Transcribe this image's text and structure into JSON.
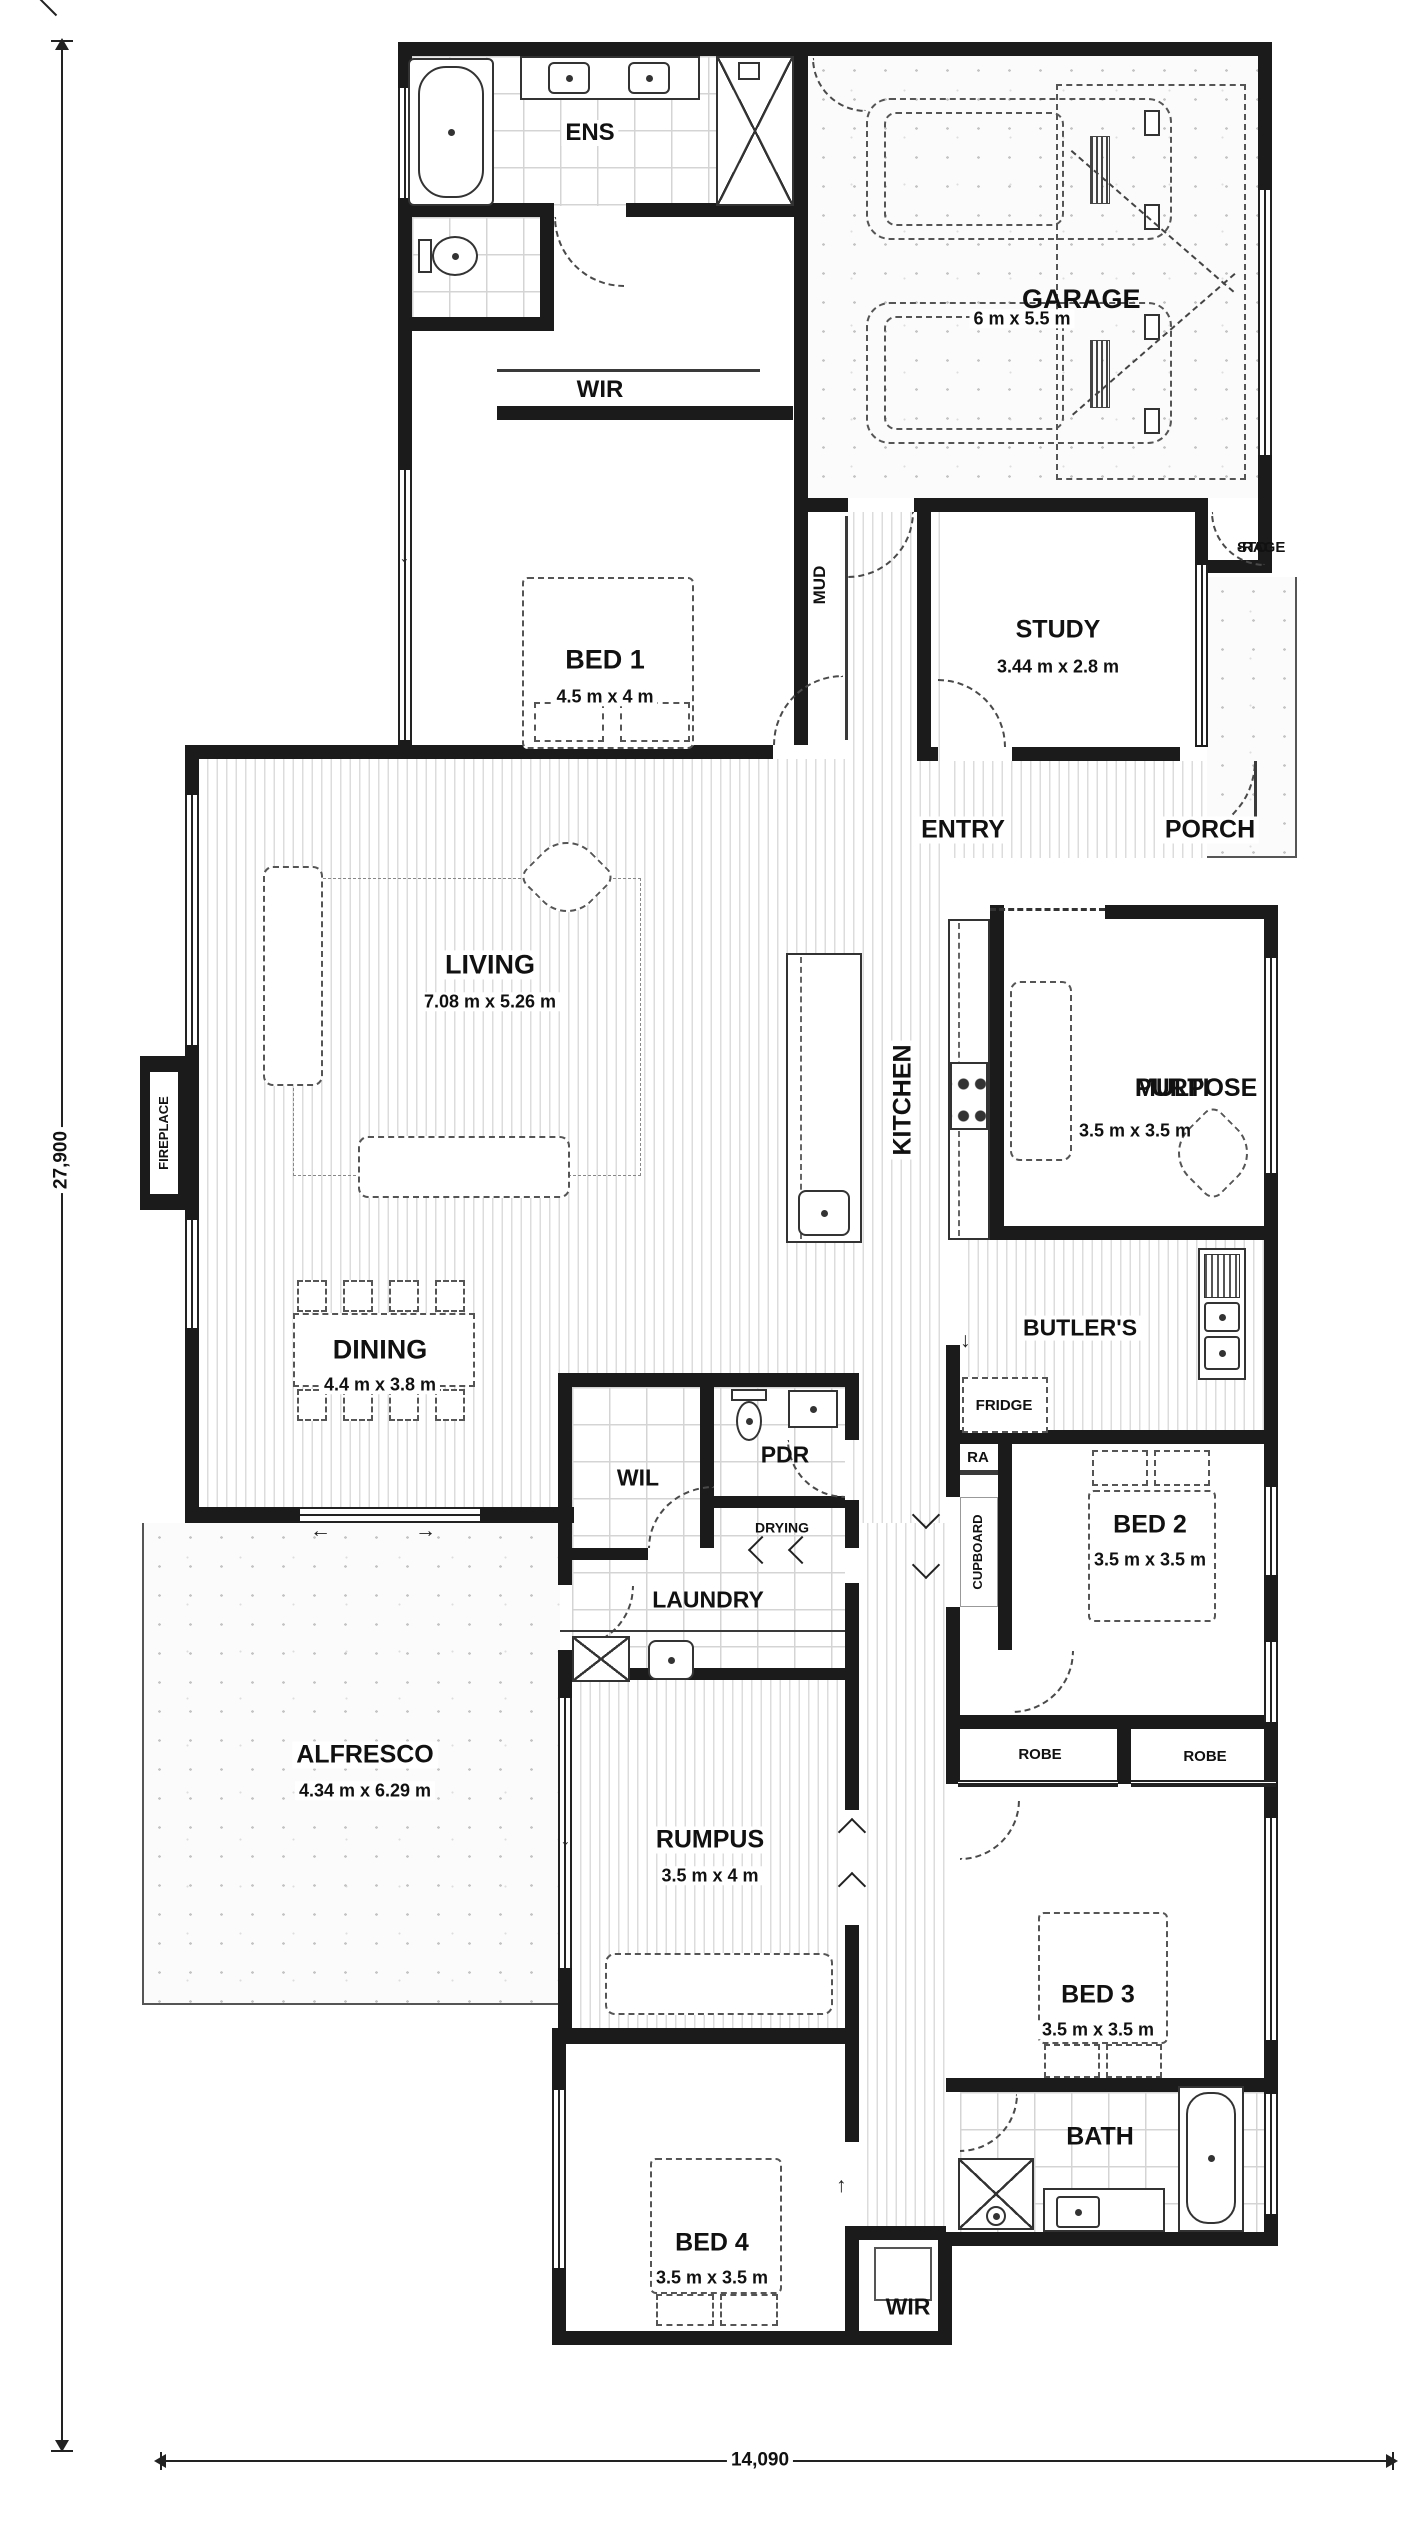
{
  "plan": {
    "overall_height": "27,900",
    "overall_width": "14,090"
  },
  "icons": {
    "arrow_up": "↑",
    "arrow_down": "↓",
    "arrow_left": "←",
    "arrow_right": "→"
  },
  "rooms": {
    "ens": {
      "name": "ENS"
    },
    "wir_upper": {
      "name": "WIR"
    },
    "garage": {
      "name": "GARAGE",
      "size": "6 m x 5.5 m"
    },
    "storage": {
      "line1": "STO",
      "line2": "-RAGE"
    },
    "mud": {
      "name": "MUD"
    },
    "study": {
      "name": "STUDY",
      "size": "3.44 m x 2.8 m"
    },
    "bed1": {
      "name": "BED 1",
      "size": "4.5 m x 4 m"
    },
    "entry": {
      "name": "ENTRY"
    },
    "porch": {
      "name": "PORCH"
    },
    "living": {
      "name": "LIVING",
      "size": "7.08 m x 5.26 m"
    },
    "kitchen": {
      "name": "KITCHEN"
    },
    "multi_purpose": {
      "line1": "MULTI",
      "line2": "PURPOSE",
      "size": "3.5 m x 3.5 m"
    },
    "fireplace": {
      "name": "FIREPLACE"
    },
    "dining": {
      "name": "DINING",
      "size": "4.4 m x 3.8 m"
    },
    "butlers": {
      "name": "BUTLER'S"
    },
    "fridge": {
      "name": "FRIDGE"
    },
    "ra": {
      "name": "RA"
    },
    "cupboard": {
      "name": "CUPBOARD"
    },
    "wil": {
      "name": "WIL"
    },
    "pdr": {
      "name": "PDR"
    },
    "drying": {
      "name": "DRYING"
    },
    "laundry": {
      "name": "LAUNDRY"
    },
    "bed2": {
      "name": "BED 2",
      "size": "3.5 m x 3.5 m"
    },
    "alfresco": {
      "name": "ALFRESCO",
      "size": "4.34 m x 6.29 m"
    },
    "robe_left": {
      "name": "ROBE"
    },
    "robe_right": {
      "name": "ROBE"
    },
    "rumpus": {
      "name": "RUMPUS",
      "size": "3.5 m x 4 m"
    },
    "bed3": {
      "name": "BED 3",
      "size": "3.5 m x 3.5 m"
    },
    "bath": {
      "name": "BATH"
    },
    "bed4": {
      "name": "BED 4",
      "size": "3.5 m x 3.5 m"
    },
    "wir_lower": {
      "name": "WIR"
    }
  }
}
